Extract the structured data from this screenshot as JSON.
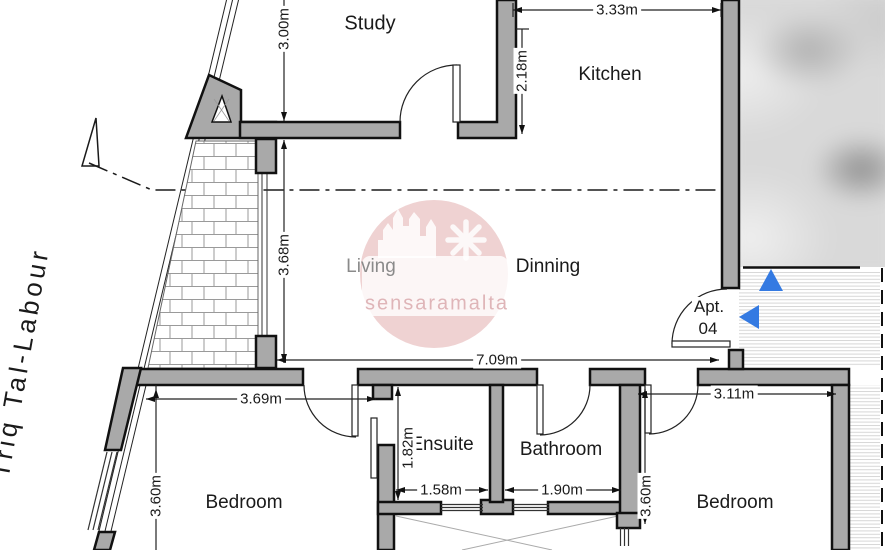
{
  "floor_plan": {
    "street_label": "Triq Tal-Labour",
    "watermark_text": "sensaramalta",
    "apartment_label": {
      "line1": "Apt.",
      "line2": "04"
    },
    "rooms": {
      "study": "Study",
      "kitchen": "Kitchen",
      "living": "Living",
      "dinning": "Dinning",
      "ensuite": "Ensuite",
      "bathroom": "Bathroom",
      "bedroom_left": "Bedroom",
      "bedroom_right": "Bedroom"
    },
    "dimensions": {
      "study_height": "3.00m",
      "kitchen_width": "3.33m",
      "kitchen_height": "2.18m",
      "living_height": "3.68m",
      "living_width": "7.09m",
      "bedroom_left_width": "3.69m",
      "bedroom_left_height": "3.60m",
      "ensuite_height": "1.82m",
      "ensuite_width": "1.58m",
      "bathroom_width": "1.90m",
      "bedroom_right_width": "3.11m",
      "bedroom_right_height": "3.60m"
    },
    "colors": {
      "wall_fill": "#a9a9a9",
      "line": "#1a1a1a",
      "arrow_blue": "#347ae2",
      "watermark_circle": "#efd2d2",
      "watermark_text_color": "#dfb5b8"
    }
  }
}
